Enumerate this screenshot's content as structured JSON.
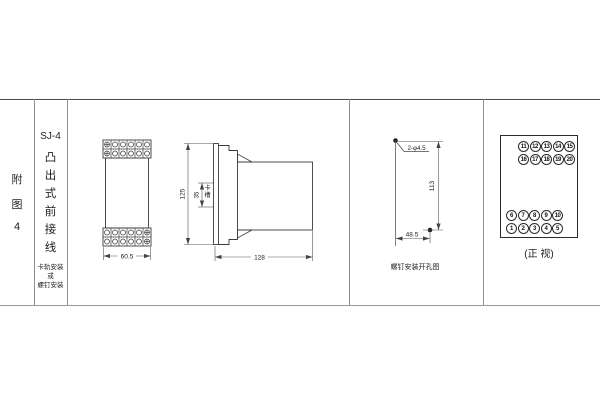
{
  "figure": {
    "index_chars": [
      "附",
      "图",
      "4"
    ],
    "model": "SJ-4",
    "type_chars": [
      "凸",
      "出",
      "式",
      "前",
      "接",
      "线"
    ],
    "mount_lines": [
      "卡轨安装",
      "或",
      "螺钉安装"
    ]
  },
  "front_view": {
    "width": "60.5"
  },
  "side_view": {
    "height": "125",
    "slot_width": "35",
    "slot_label": "卡槽",
    "depth": "128"
  },
  "drill_view": {
    "holes": "2-φ4.5",
    "vertical": "113",
    "horizontal": "48.5",
    "caption": "螺钉安装开孔图"
  },
  "terminal_view": {
    "top_rows": [
      [
        "11",
        "12",
        "13",
        "14",
        "15"
      ],
      [
        "16",
        "17",
        "18",
        "19",
        "20"
      ]
    ],
    "bottom_rows": [
      [
        "6",
        "7",
        "8",
        "9",
        "10"
      ],
      [
        "1",
        "2",
        "3",
        "4",
        "5"
      ]
    ],
    "caption": "(正 视)"
  },
  "colors": {
    "object_line": "#3a3a3a",
    "dim_line": "#555555",
    "table_line": "#8f8f8f"
  }
}
